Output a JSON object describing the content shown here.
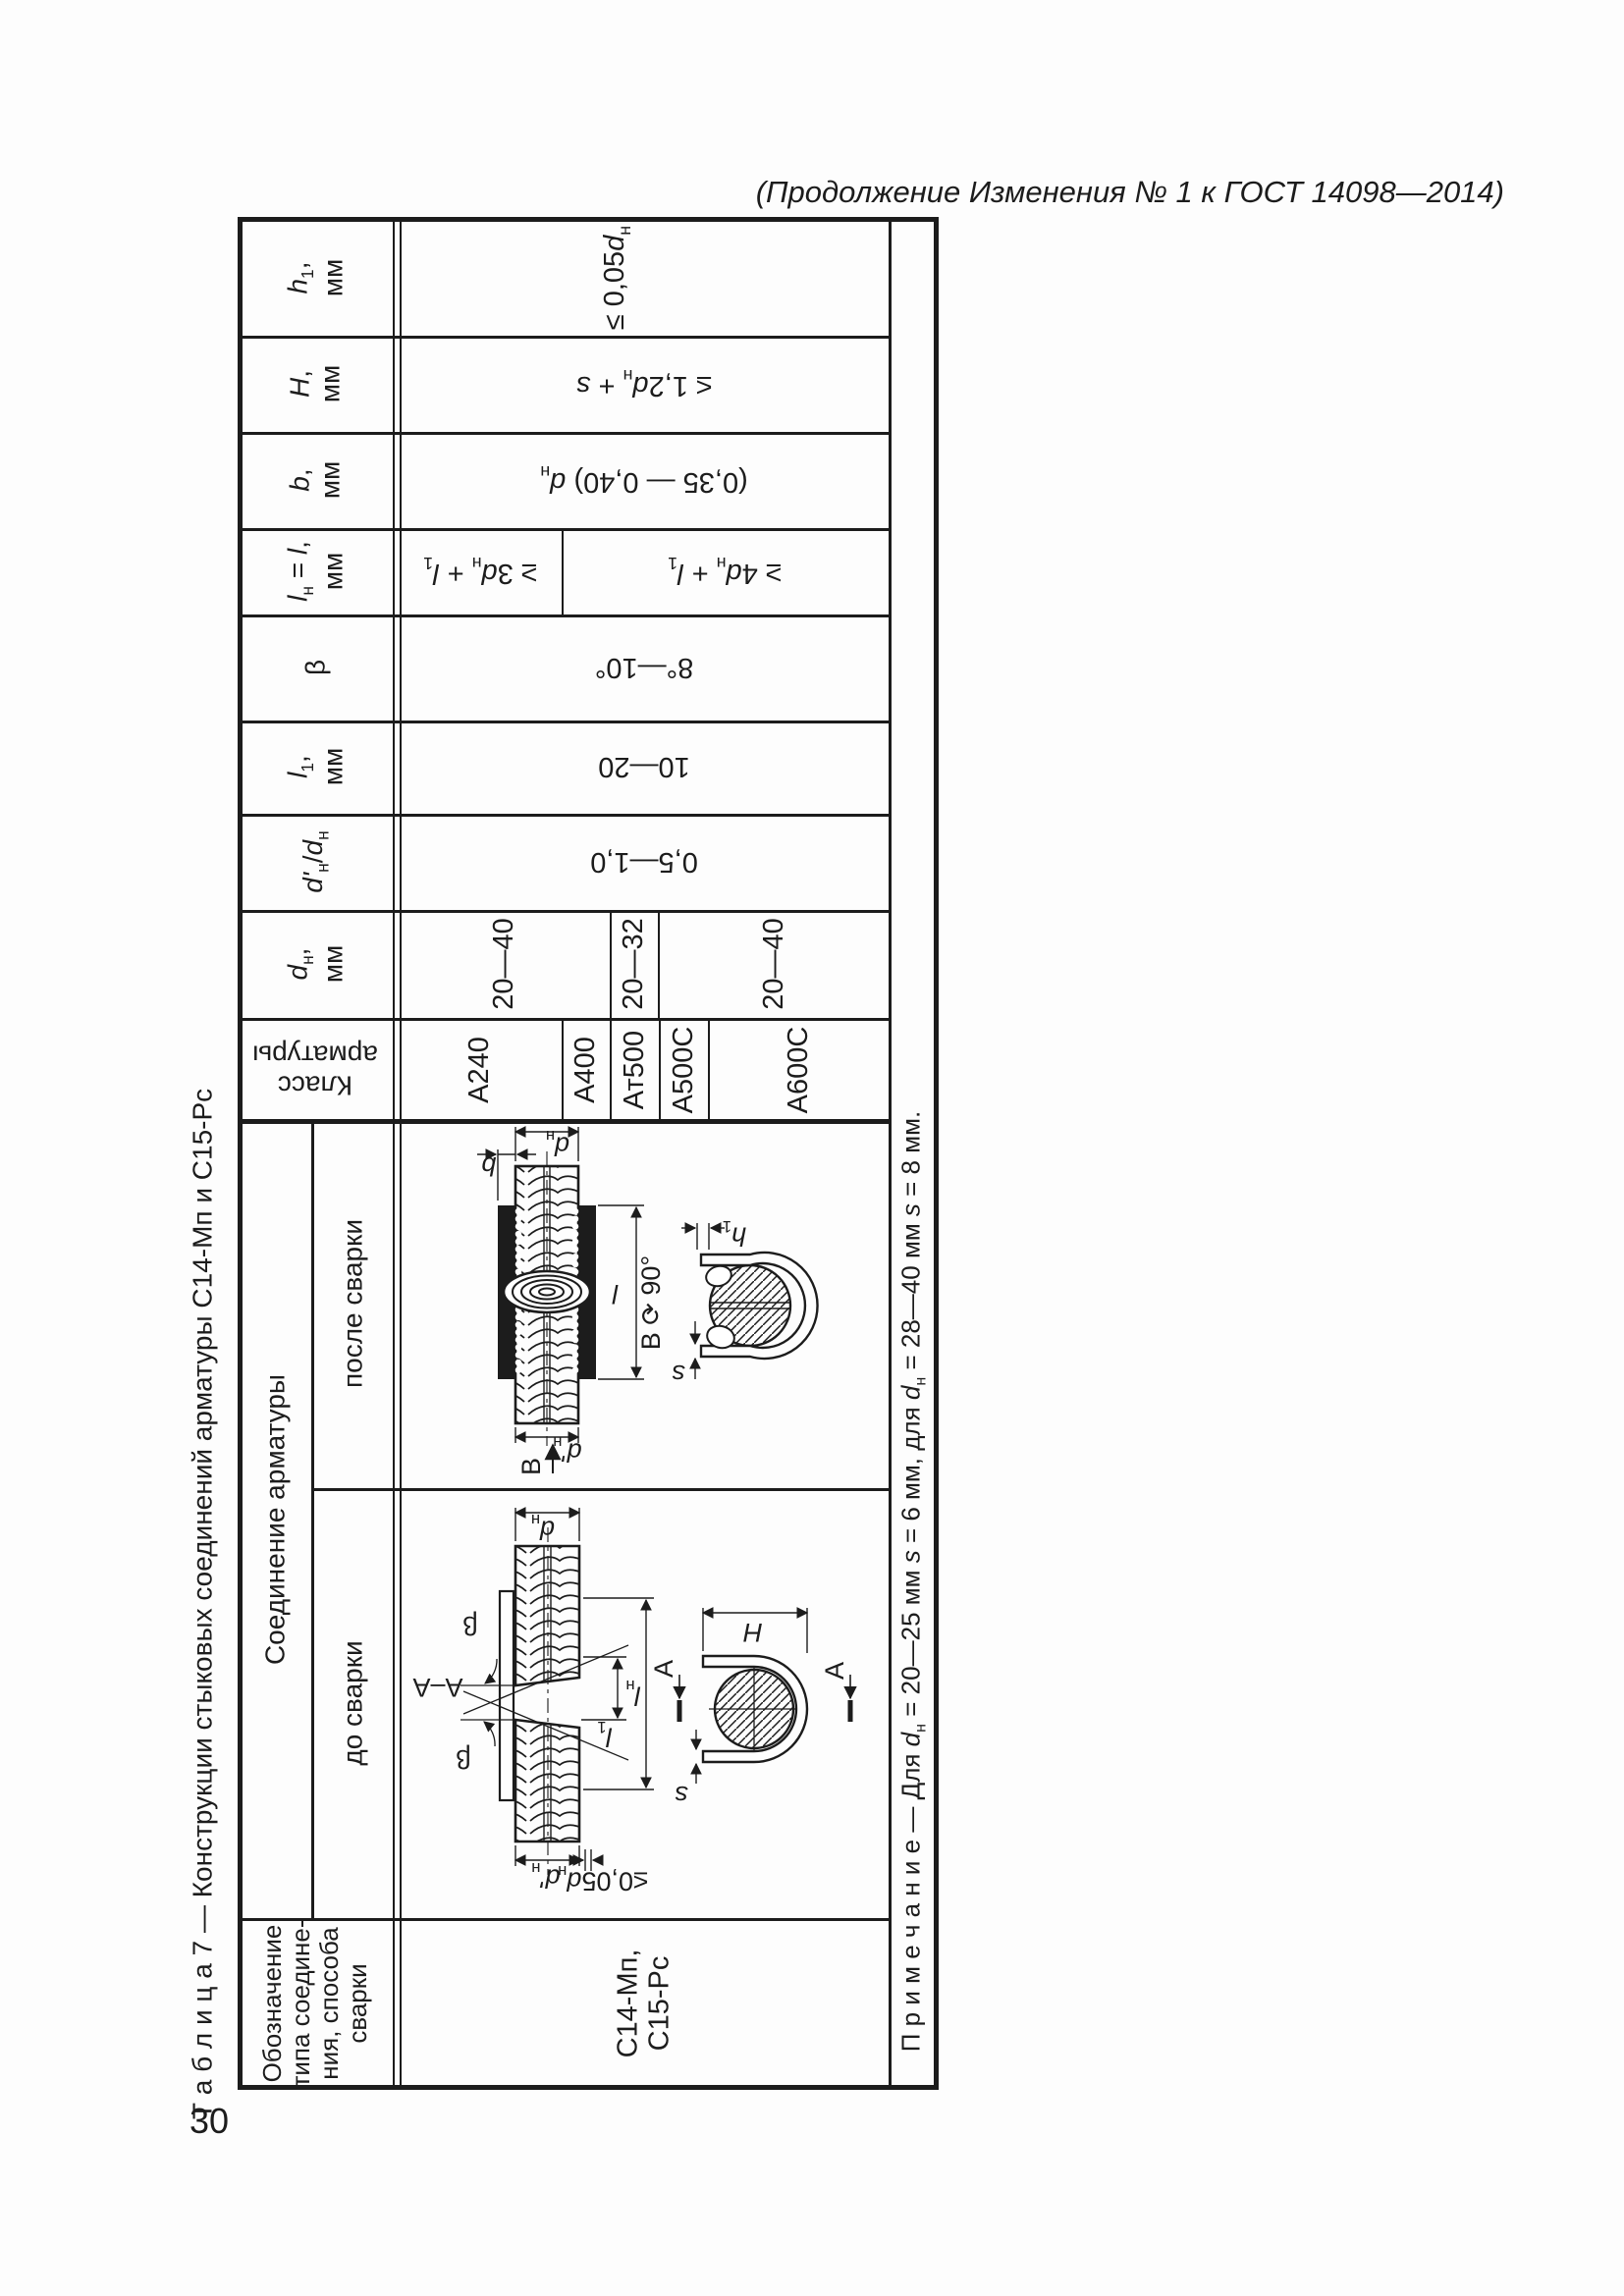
{
  "page": {
    "heading": "(Продолжение Изменения № 1 к ГОСТ 14098—2014)",
    "page_number": "30",
    "caption": "Т а б л и ц а  7 — Конструкции стыковых соединений арматуры С14-Мп и С15-Рс"
  },
  "table": {
    "headers": {
      "designation": "Обозначение<br>типа соедине-<br>ния, способа<br>сварки",
      "joint_group": "Соединение арматуры",
      "before_welding": "до сварки",
      "after_welding": "после сварки",
      "klass": "Класс<br>арматуры",
      "dn": "<i>d</i><sub>н</sub>,<br>мм",
      "dn_ratio": "<i>d'</i><sub>н</sub>/<i>d</i><sub>н</sub>",
      "l1": "<i>l</i><sub>1</sub>,<br>мм",
      "beta": "β",
      "ln": "<i>l</i><sub>н</sub> = <i>l</i>,<br>мм",
      "b": "<i>b</i>,<br>мм",
      "H": "<i>Н</i>,<br>мм",
      "h1": "<i>h</i><sub>1</sub>,<br>мм"
    },
    "values": {
      "designation": "С14-Мп,<br>С15-Рс",
      "classes": [
        "А240",
        "А400",
        "Ат500",
        "А500С",
        "А600С"
      ],
      "dn": [
        "20—40",
        "20—32",
        "20—40"
      ],
      "dn_ratio": "0,5—1,0",
      "l1": "10—20",
      "beta": "8°—10°",
      "ln_a240": "≥ 3<i>d</i><sub>н</sub> + <i>l</i><sub>1</sub>",
      "ln_others": "≥ 4<i>d</i><sub>н</sub> + <i>l</i><sub>1</sub>",
      "b": "(0,35 — 0,40) <i>d</i><sub>н</sub>",
      "H": "≤ 1,2<i>d</i><sub>н</sub> + <i>s</i>",
      "h1": "≤ 0,05<i>d</i><sub>н</sub>"
    },
    "note": "П р и м е ч а н и е — Для <i>d</i><sub>н</sub> = 20—25 мм <i>s</i> = 6 мм, для <i>d</i><sub>н</sub> = 28—40 мм <i>s</i> = 8 мм."
  },
  "diagram_after": {
    "dn": "<i>d</i><sub>н</sub>",
    "b": "<i>b</i>",
    "l": "<i>l</i>",
    "rotated_view": "В ⟳ 90°",
    "h1": "<i>h</i><sub>1</sub>",
    "s": "<i>s</i>",
    "dn2": "<i>d'</i><sub>н</sub>",
    "view_b": "В"
  },
  "diagram_before": {
    "dn": "<i>d</i><sub>н</sub>",
    "beta1": "β",
    "beta2": "β",
    "section": "А–А",
    "ln": "<i>l</i><sub>н</sub>",
    "l1": "<i>l</i><sub>1</sub>",
    "dn2": "<i>d'</i><sub>н</sub>",
    "axis_offset": "≤0,05<i>d</i><sub>н</sub>",
    "H": "<i>Н</i>",
    "s": "<i>s</i>",
    "a_left": "А",
    "a_right": "А"
  }
}
